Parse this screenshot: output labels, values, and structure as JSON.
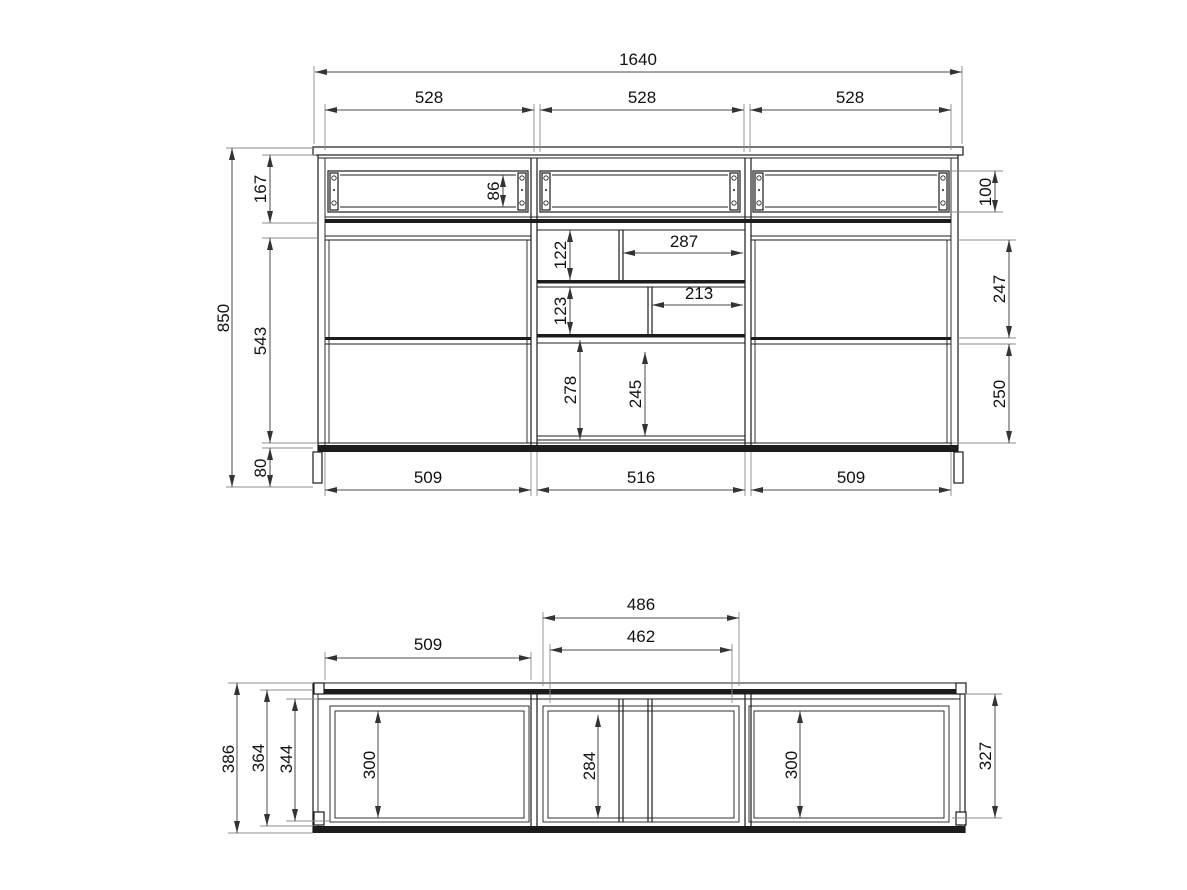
{
  "front_view": {
    "total_width": "1640",
    "sections": [
      "528",
      "528",
      "528"
    ],
    "total_height": "850",
    "drawer_zone_height": "167",
    "drawer_panel_height": "86",
    "drawer_front_height": "100",
    "body_zone_height": "543",
    "plinth_height": "80",
    "shelf_upper_height": "122",
    "shelf_upper_width": "287",
    "shelf_lower_height": "123",
    "shelf_lower_width": "213",
    "open_left_height": "278",
    "open_mid_height": "245",
    "upper_door_height": "247",
    "lower_door_height": "250",
    "openings": [
      "509",
      "516",
      "509"
    ]
  },
  "plan_view": {
    "left_opening_width": "509",
    "mid_outer_width": "486",
    "mid_inner_width": "462",
    "depth_total": "386",
    "depth_body": "364",
    "depth_inner": "344",
    "left_opening_depth": "300",
    "mid_opening_depth": "284",
    "right_opening_depth": "300",
    "right_side_depth": "327"
  }
}
